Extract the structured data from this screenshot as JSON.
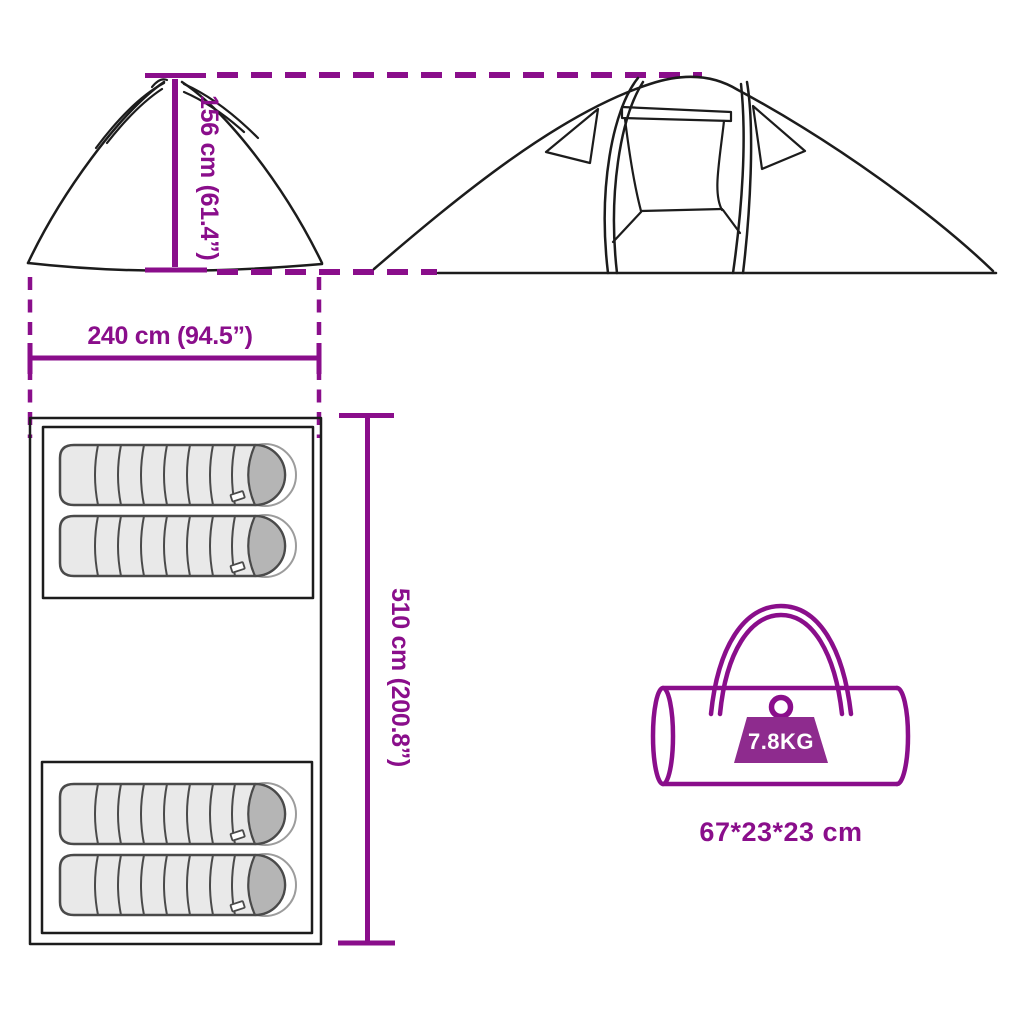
{
  "diagram_title": "tent-dimensions-diagram",
  "colors": {
    "accent": "#8A0E8B",
    "weight_fill": "#8E2B8E",
    "line": "#1c1c1c",
    "sleeping_bag_body": "#e9e9e9",
    "sleeping_bag_head": "#b5b5b5"
  },
  "dimensions": {
    "height_label": "156 cm (61.4”)",
    "width_label": "240 cm (94.5”)",
    "length_label": "510 cm (200.8”)"
  },
  "carry_bag": {
    "weight_label": "7.8KG",
    "size_label": "67*23*23 cm"
  },
  "icons": {
    "weight_icon": "kettlebell-weight",
    "sleeping_bag_icon": "sleeping-bag"
  }
}
